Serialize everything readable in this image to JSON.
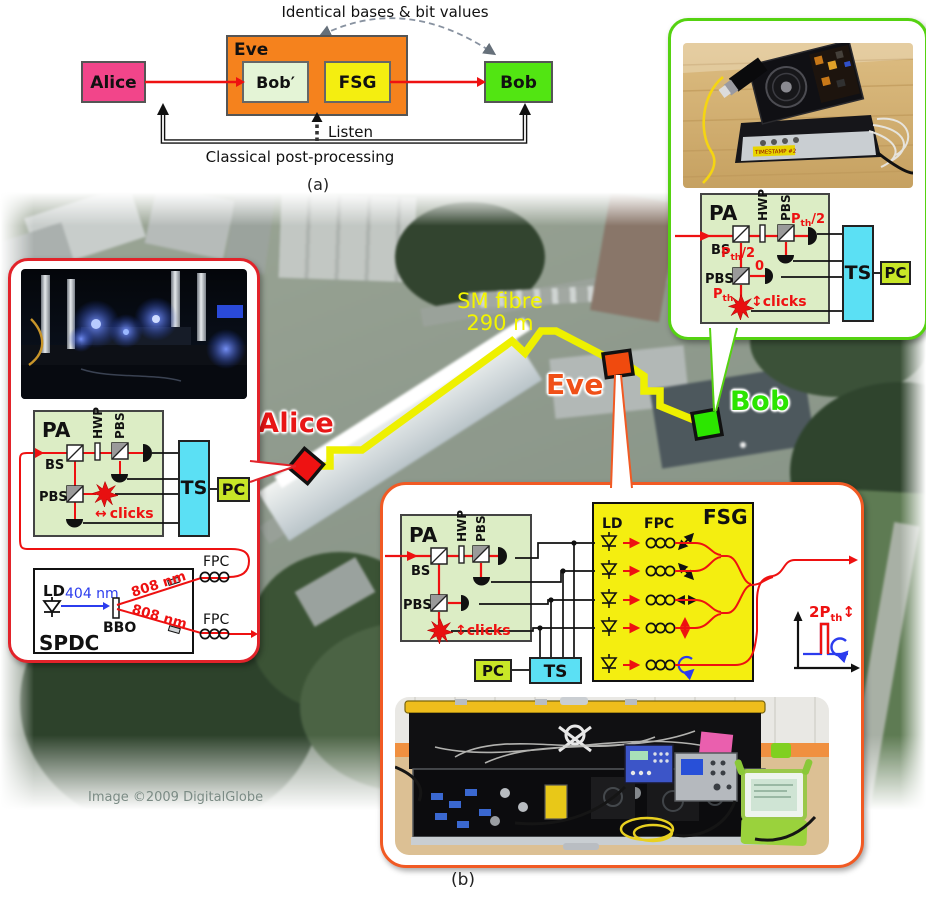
{
  "panel_a": {
    "annotation": "Identical bases & bit values",
    "alice": "Alice",
    "eve": "Eve",
    "bob_prime": "Bob′",
    "fsg": "FSG",
    "bob": "Bob",
    "listen": "Listen",
    "classical": "Classical post-processing",
    "caption": "(a)"
  },
  "map": {
    "alice": "Alice",
    "eve": "Eve",
    "bob": "Bob",
    "fibre_line1": "SM fibre",
    "fibre_line2": "290 m",
    "credit": "Image ©2009 DigitalGlobe",
    "caption": "(b)"
  },
  "optics": {
    "pa": "PA",
    "bs": "BS",
    "hwp": "HWP",
    "pbs": "PBS",
    "ts": "TS",
    "pc": "PC",
    "p": "P",
    "th": "th",
    "half_suffix": "/2",
    "zero": "0",
    "two": "2",
    "updown_arrow": "↕",
    "leftright_arrow": "↔",
    "clicks": "clicks"
  },
  "spdc": {
    "ld": "LD",
    "pump_wavelength": "404 nm",
    "bbo": "BBO",
    "down_wavelength_1": "808 nm",
    "down_wavelength_2": "808 nm",
    "fpc_1": "FPC",
    "fpc_2": "FPC",
    "title": "SPDC"
  },
  "fsg": {
    "ld": "LD",
    "fpc": "FPC",
    "title": "FSG"
  },
  "bob_device": {
    "label": "TIMESTAMP #2"
  },
  "colors": {
    "alice_pink": "#f2458a",
    "eve_orange": "#f5821d",
    "bob_green": "#52e512",
    "fsg_yellow": "#f4ee10",
    "bob_prime_green": "#e4f4d6",
    "beam_red": "#ee1111",
    "fibre_yellow": "#eef000",
    "pa_green": "#dcedc5",
    "ts_cyan": "#5be0f4",
    "pc_yellow_green": "#c8e627",
    "callout_red": "#e2232a",
    "callout_green": "#55d211",
    "callout_orange": "#f15a24",
    "map_alice_red": "#e81616",
    "map_eve_orange": "#f05018",
    "map_bob_green": "#2be400"
  }
}
